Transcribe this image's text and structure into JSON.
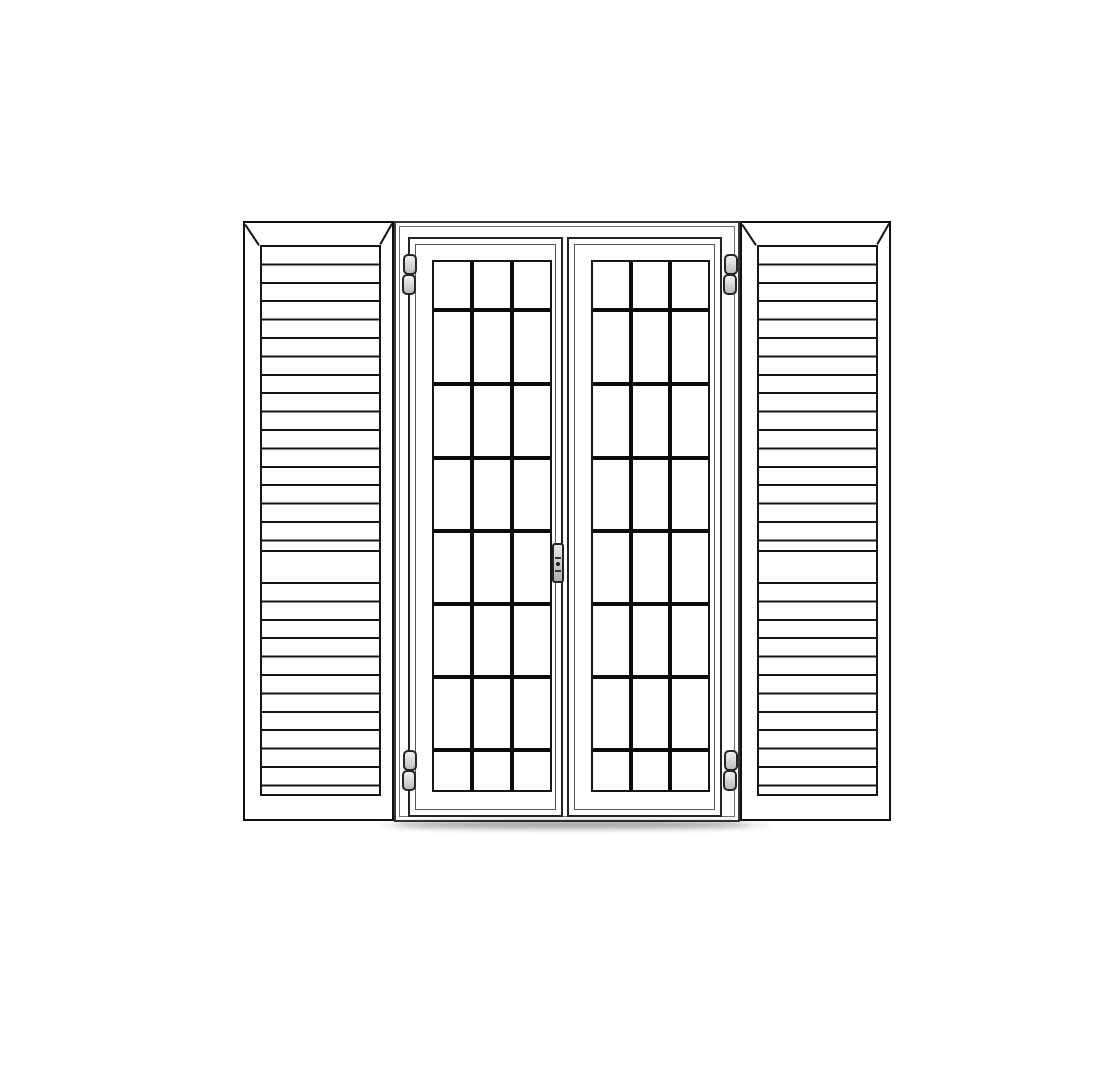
{
  "scene": {
    "type": "technical-line-drawing",
    "subject": "double french door with glazing-bar grid flanked by two louvered shutters",
    "background": "#ffffff"
  },
  "colors": {
    "outline": "#141414",
    "shutter_line": "#101010",
    "frame_line": "#383838",
    "thin_line": "#6f6f6f",
    "muntin": "#0c0c0c",
    "hardware_outline": "#262626",
    "hardware_fill_light": "#f0f0f0",
    "hardware_fill_dark": "#bdbdbd",
    "shadow": "#000000"
  },
  "canvas": {
    "width": 1108,
    "height": 1092
  },
  "shutters": {
    "count": 2,
    "left": {
      "x": 243,
      "y": 221,
      "w": 151,
      "h": 600
    },
    "right": {
      "x": 740,
      "y": 221,
      "w": 151,
      "h": 600
    },
    "louver": {
      "inset_left": 15,
      "inset_right": 15,
      "inset_top": 22,
      "inset_bottom": 27,
      "upper_section_h": 305,
      "mid_rail_h": 30,
      "lower_section_h": 216,
      "slat_pitch": 18.4,
      "slat_line_w": 2
    }
  },
  "door": {
    "frame": {
      "x": 394,
      "y": 221,
      "w": 346,
      "h": 601
    },
    "leaves": [
      {
        "x": 408,
        "y": 237,
        "w": 155,
        "h": 580,
        "glass": {
          "l": 22,
          "t": 21,
          "w": 120,
          "h": 532
        }
      },
      {
        "x": 567,
        "y": 237,
        "w": 155,
        "h": 580,
        "glass": {
          "l": 22,
          "t": 21,
          "w": 119,
          "h": 532
        }
      }
    ],
    "grid": {
      "columns": 3,
      "rows": 8,
      "horizontal_muntin_offsets": [
        50,
        124,
        198,
        271,
        344,
        417,
        490
      ],
      "muntin_thickness": 4
    }
  },
  "hardware": {
    "hinge_count": 4,
    "hinges": [
      {
        "id": "hinge-top-left",
        "x": 402,
        "y": 254
      },
      {
        "id": "hinge-top-right",
        "x": 723,
        "y": 254
      },
      {
        "id": "hinge-bottom-left",
        "x": 402,
        "y": 750
      },
      {
        "id": "hinge-bottom-right",
        "x": 723,
        "y": 750
      }
    ],
    "hinge_size": {
      "w": 14,
      "knuckle_h": 21
    },
    "handle": {
      "x": 552,
      "y": 543,
      "w": 12,
      "h": 40,
      "divider_offsets": [
        12,
        25
      ],
      "dot": {
        "x": 4,
        "y": 17
      }
    }
  },
  "shadows": [
    {
      "x": 380,
      "y": 820,
      "w": 390,
      "h": 10,
      "opacity": 0.12,
      "blur": 3
    },
    {
      "x": 394,
      "y": 821,
      "w": 356,
      "h": 7,
      "opacity": 0.3,
      "blur": 3
    }
  ]
}
